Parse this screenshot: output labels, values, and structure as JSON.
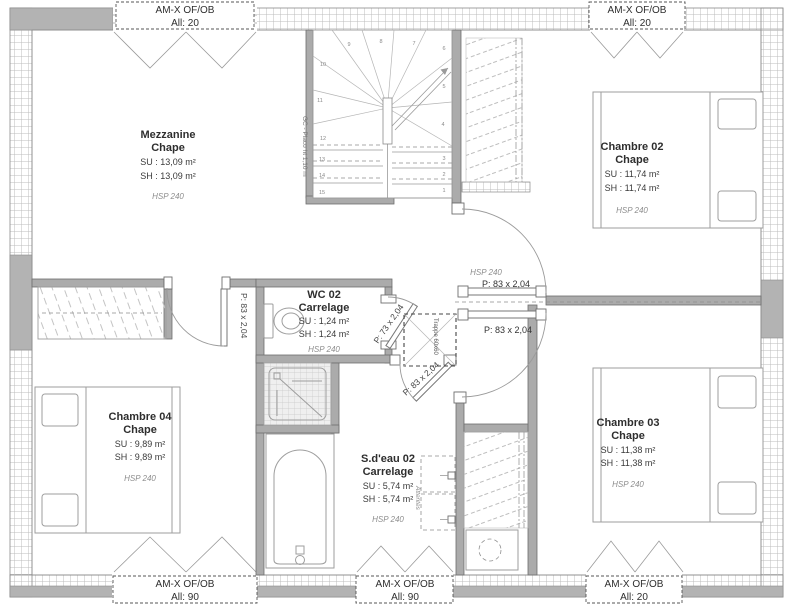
{
  "plan": {
    "windows": {
      "top_left": {
        "line1": "AM-X OF/OB",
        "line2": "All: 20"
      },
      "top_right": {
        "line1": "AM-X OF/OB",
        "line2": "All: 20"
      },
      "bottom_left": {
        "line1": "AM-X OF/OB",
        "line2": "All: 90"
      },
      "bottom_middle": {
        "line1": "AM-X OF/OB",
        "line2": "All: 90"
      },
      "bottom_right": {
        "line1": "AM-X OF/OB",
        "line2": "All: 20"
      }
    },
    "rooms": {
      "mezzanine": {
        "name": "Mezzanine",
        "finish": "Chape",
        "su": "SU : 13,09 m²",
        "sh": "SH : 13,09 m²",
        "hsp": "HSP 240"
      },
      "chambre02": {
        "name": "Chambre 02",
        "finish": "Chape",
        "su": "SU : 11,74 m²",
        "sh": "SH : 11,74 m²",
        "hsp": "HSP 240"
      },
      "chambre03": {
        "name": "Chambre 03",
        "finish": "Chape",
        "su": "SU : 11,38 m²",
        "sh": "SH : 11,38 m²",
        "hsp": "HSP 240"
      },
      "chambre04": {
        "name": "Chambre 04",
        "finish": "Chape",
        "su": "SU : 9,89 m²",
        "sh": "SH : 9,89 m²",
        "hsp": "HSP 240"
      },
      "wc02": {
        "name": "WC 02",
        "finish": "Carrelage",
        "su": "SU : 1,24 m²",
        "sh": "SH : 1,24 m²",
        "hsp": "HSP 240"
      },
      "sdeau02": {
        "name": "S.d'eau 02",
        "finish": "Carrelage",
        "su": "SU : 5,74 m²",
        "sh": "SH : 5,74 m²",
        "hsp": "HSP 240"
      },
      "degagement": {
        "hsp": "HSP 240"
      }
    },
    "doors": {
      "chambre04": "P: 83 x 2,04",
      "wc02": "P: 73 x 2,04",
      "sdeau02": "P: 83 x 2,04",
      "chambre02": "P: 83 x 2,04",
      "chambre03": "P: 83 x 2,04"
    },
    "stairs": {
      "numbers": [
        "1",
        "2",
        "3",
        "4",
        "5",
        "6",
        "7",
        "8",
        "9",
        "10",
        "11",
        "12",
        "13",
        "14",
        "15"
      ],
      "guard_note": "GC - Placo ht 1,10 m"
    },
    "annotations": {
      "trappe": "Trappe 60x60",
      "attentes": "Attentes"
    },
    "colors": {
      "wall_gray": "#ababab",
      "line_gray": "#9a9a9a",
      "text_dark": "#2e2e2e"
    }
  }
}
